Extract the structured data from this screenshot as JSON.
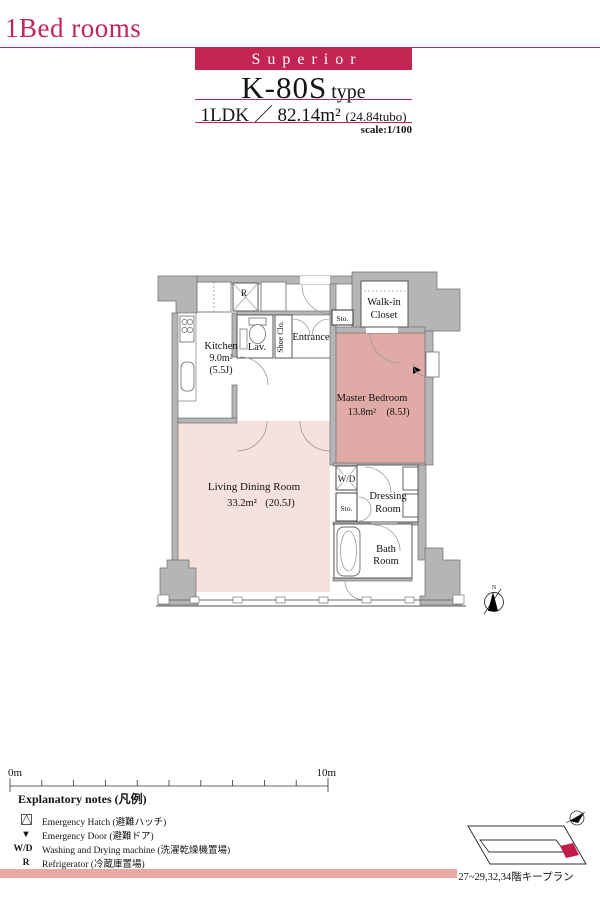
{
  "page": {
    "category_title": "1Bed rooms",
    "grade_label": "Superior",
    "type_name": "K-80S",
    "type_suffix": "type",
    "layout": "1LDK",
    "separator": "／",
    "area": "82.14m²",
    "area_tubo": "(24.84tubo)",
    "scale_label": "scale:1/100"
  },
  "colors": {
    "accent_crimson": "#c32552",
    "living_pink": "#f7e1dd",
    "bedroom_pink": "#e0aba6",
    "wall_gray": "#b5b5b5",
    "footer_stripe_pink": "#e9a9a3",
    "keyplan_unit_crimson": "#c31a4a"
  },
  "plan": {
    "rooms": {
      "kitchen": {
        "name": "Kitchen",
        "area": "9.0m²",
        "tatami": "(5.5J)"
      },
      "lavatory": {
        "name": "Lav."
      },
      "shoe_closet": {
        "name": "Shoe Clo."
      },
      "entrance": {
        "name": "Entrance"
      },
      "storage_top": {
        "name": "Sto."
      },
      "walk_in_closet": {
        "line1": "Walk-in",
        "line2": "Closet"
      },
      "master_bedroom": {
        "name": "Master Bedroom",
        "area": "13.8m²",
        "tatami": "(8.5J)"
      },
      "living_dining": {
        "name": "Living Dining Room",
        "area": "33.2m²",
        "tatami": "(20.5J)"
      },
      "wd": {
        "name": "W/D"
      },
      "storage_mid": {
        "name": "Sto."
      },
      "dressing": {
        "line1": "Dressing",
        "line2": "Room"
      },
      "bath": {
        "line1": "Bath",
        "line2": "Room"
      },
      "refrigerator": {
        "name": "R"
      }
    },
    "compass_label": "N"
  },
  "scale_bar": {
    "start": "0m",
    "end": "10m"
  },
  "legend": {
    "title": "Explanatory notes (凡例)",
    "items": [
      {
        "symbol": "",
        "label": "Emergency Hatch (避難ハッチ)"
      },
      {
        "symbol": "▼",
        "label": "Emergency Door (避難ドア)"
      },
      {
        "symbol": "W/D",
        "label": "Washing and Drying machine (洗濯乾燥機置場)"
      },
      {
        "symbol": "R",
        "label": "Refrigerator (冷蔵庫置場)"
      }
    ]
  },
  "key_plan": {
    "caption": "27~29,32,34階キープラン"
  }
}
